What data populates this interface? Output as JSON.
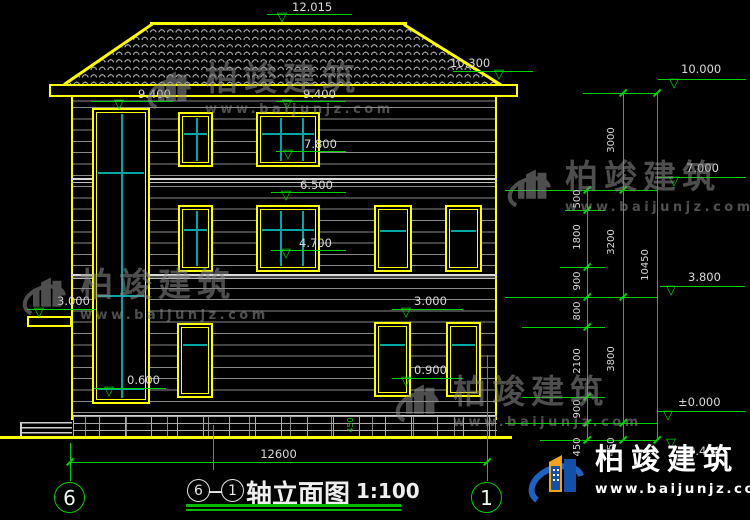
{
  "title": {
    "axis_from": "6",
    "separator": "—",
    "axis_to": "1",
    "text": "轴立面图",
    "scale": "1:100"
  },
  "axis_bubbles": {
    "left": "6",
    "right": "1"
  },
  "facade_elevations": {
    "ridge": "12.015",
    "eave_left": "9.400",
    "eave_right": "9.400",
    "eave_edge": "10.300",
    "f3_sill": "7.800",
    "f2_head": "6.500",
    "f2_sill": "4.700",
    "canopy": "3.000",
    "stair_sill": "0.600",
    "f1_head": "3.000",
    "f1_sill": "0.900"
  },
  "right_elevations": {
    "lv10": "10.000",
    "lv7": "7.000",
    "lv38": "3.800",
    "lv0": "±0.000",
    "lvm045": "0.450"
  },
  "dims": {
    "total_width": "12600",
    "overall_height": "10450",
    "plinth_height": "450",
    "inner_chain": [
      "500",
      "1800",
      "900",
      "800",
      "2100",
      "900",
      "450"
    ],
    "mid_chain": [
      "3000",
      "3200",
      "3800",
      "450"
    ]
  },
  "watermark": {
    "brand": "柏竣建筑",
    "url": "www.baijunjz.com"
  },
  "site_logo": {
    "brand": "柏竣建筑",
    "url": "www.baijunjz.com"
  }
}
